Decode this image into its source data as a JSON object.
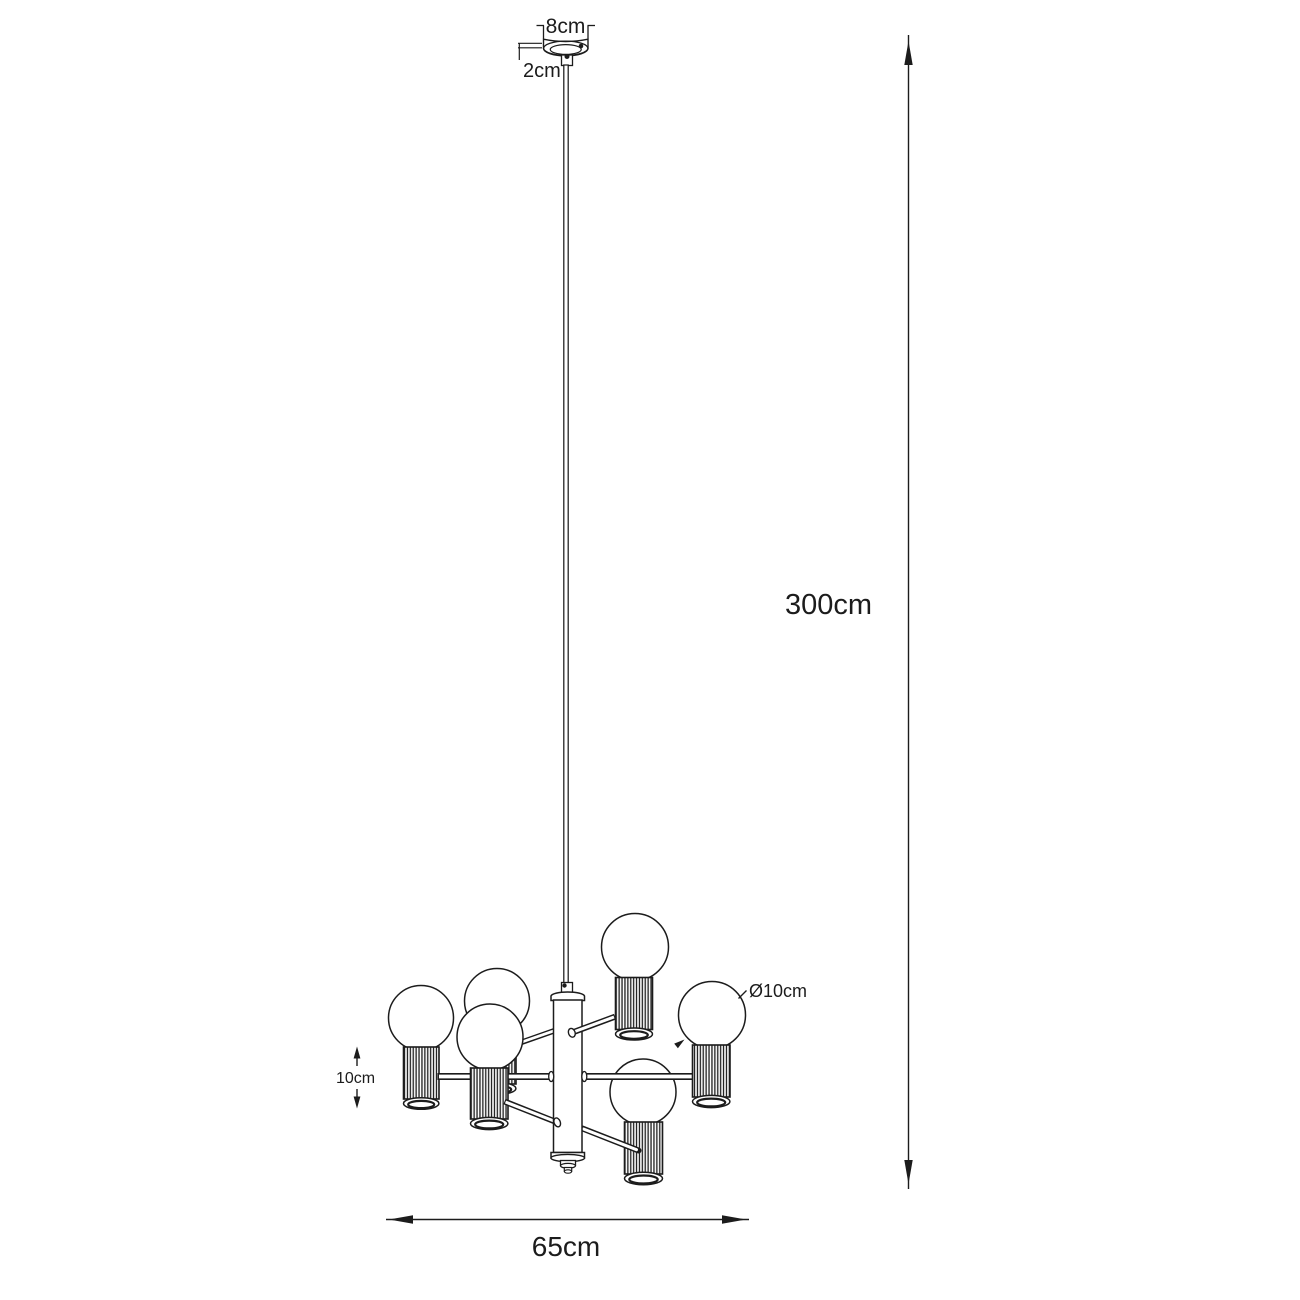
{
  "canvas": {
    "background": "#ffffff",
    "line_color": "#1c1c1c"
  },
  "drawing": {
    "type": "product-dimension-diagram",
    "bulb_count": 6,
    "annotations": {
      "canopy_width": "8cm",
      "canopy_height": "2cm",
      "suspension_height": "300cm",
      "bulb_diameter": "Ø10cm",
      "shade_height": "10cm",
      "fixture_width": "65cm"
    }
  }
}
